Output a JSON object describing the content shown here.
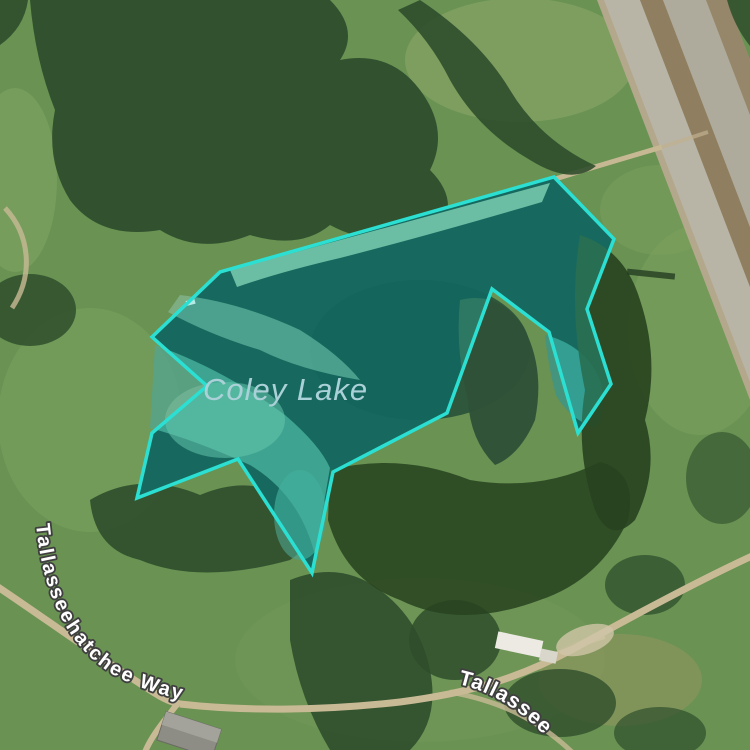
{
  "map": {
    "view_type": "satellite-imagery",
    "labels": {
      "lake_name": "Coley Lake",
      "road_west": "Tallasseehatchee Way",
      "road_southeast_partial": "Tallassee"
    },
    "overlay": {
      "feature": "lake-boundary-highlight",
      "polygon_points": "554,177 614,239 587,309 611,384 578,433 549,332 492,289 447,413 333,472 312,573 238,459 137,498 152,433 207,386 152,337 220,272",
      "stroke_color": "#2be0d2",
      "fill_color": "rgba(45,216,203,0.30)"
    },
    "colors": {
      "field_green": "#699253",
      "forest_green": "#2f4e2c",
      "water_dark_green": "#0d3a31",
      "shallow_water": "#9ccaa4",
      "dirt_road_tan": "#c9ba96",
      "highway_tan": "#b3a88c",
      "highway_median_brown": "#8f7f60",
      "lake_label_text": "#abd1d8",
      "road_label_fill": "#ffffff",
      "road_label_outline": "#3f3f3f"
    }
  }
}
